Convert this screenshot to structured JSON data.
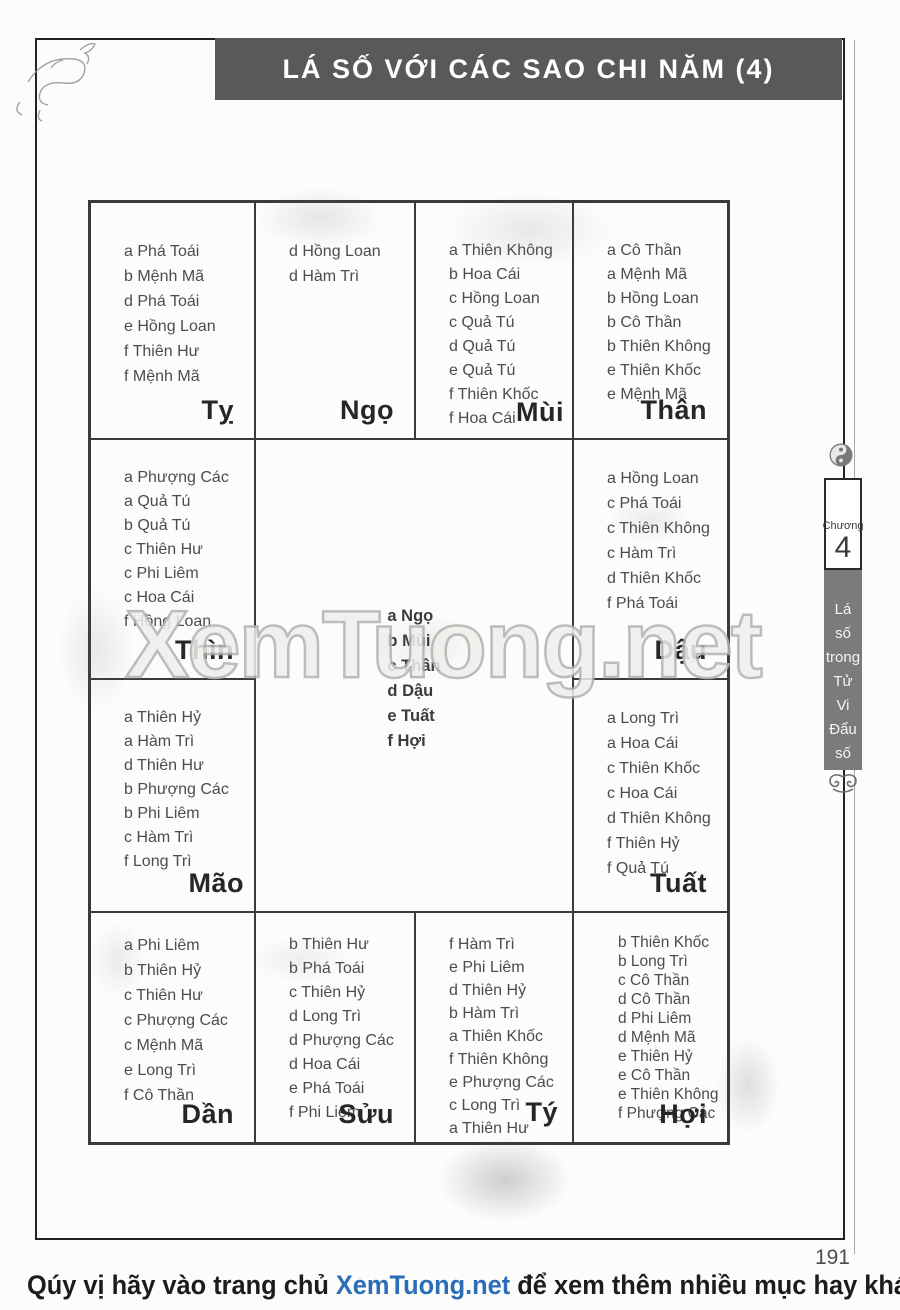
{
  "header": {
    "title": "LÁ SỐ VỚI CÁC SAO CHI NĂM (4)"
  },
  "sidebar": {
    "chapter_label": "Chương",
    "chapter_number": "4",
    "chapter_title_words": [
      "Lá",
      "số",
      "trong",
      "Tử",
      "Vi",
      "Đẩu",
      "số"
    ]
  },
  "watermark": {
    "text": "XemTuong.net"
  },
  "footer": {
    "page_number": "191",
    "promo_prefix": "Qúy vị hãy vào trang chủ ",
    "promo_link": "XemTuong.net",
    "promo_suffix": " để xem thêm nhiều mục hay khác",
    "link_color": "#2a6db8"
  },
  "chart": {
    "type": "table",
    "description": "Tử Vi palace chart of yearly stars by earthly branch",
    "cells": [
      {
        "id": "ty",
        "label": "Tỵ",
        "stars": [
          "a Phá Toái",
          "b Mệnh Mã",
          "d Phá Toái",
          "e Hồng Loan",
          "f Thiên Hư",
          "f Mệnh Mã"
        ]
      },
      {
        "id": "ngo",
        "label": "Ngọ",
        "stars": [
          "d Hồng Loan",
          "d Hàm Trì"
        ]
      },
      {
        "id": "mui",
        "label": "Mùi",
        "stars": [
          "a Thiên Không",
          "b Hoa Cái",
          "c Hồng Loan",
          "c Quả Tú",
          "d Quả Tú",
          "e Quả Tú",
          "f Thiên Khốc",
          "f Hoa Cái"
        ]
      },
      {
        "id": "than",
        "label": "Thân",
        "stars": [
          "a Cô Thần",
          "a Mệnh Mã",
          "b Hồng Loan",
          "b Cô Thần",
          "b Thiên Không",
          "e Thiên Khốc",
          "e Mệnh Mã"
        ]
      },
      {
        "id": "thin",
        "label": "Thìn",
        "stars": [
          "a Phượng Các",
          "a Quả Tú",
          "b Quả Tú",
          "c Thiên Hư",
          "c Phi Liêm",
          "c Hoa Cái",
          "f Hồng Loan"
        ]
      },
      {
        "id": "dau",
        "label": "Dậu",
        "stars": [
          "a Hồng Loan",
          "c Phá Toái",
          "c Thiên Không",
          "c Hàm Trì",
          "d Thiên Khốc",
          "f Phá Toái"
        ]
      },
      {
        "id": "mao",
        "label": "Mão",
        "stars": [
          "a Thiên Hỷ",
          "a Hàm Trì",
          "d Thiên Hư",
          "b Phượng Các",
          "b Phi Liêm",
          "c Hàm Trì",
          "f Long Trì"
        ]
      },
      {
        "id": "tuat",
        "label": "Tuất",
        "stars": [
          "a Long Trì",
          "a Hoa Cái",
          "c Thiên Khốc",
          "c Hoa Cái",
          "d Thiên Không",
          "f Thiên Hỷ",
          "f Quả Tú"
        ]
      },
      {
        "id": "dan",
        "label": "Dần",
        "stars": [
          "a Phi Liêm",
          "b Thiên Hỷ",
          "c Thiên Hư",
          "c Phượng Các",
          "c Mệnh Mã",
          "e Long Trì",
          "f Cô Thần"
        ]
      },
      {
        "id": "suu",
        "label": "Sửu",
        "stars": [
          "b Thiên Hư",
          "b Phá Toái",
          "c Thiên Hỷ",
          "d Long Trì",
          "d Phượng Các",
          "d Hoa Cái",
          "e Phá Toái",
          "f Phi Liêm"
        ]
      },
      {
        "id": "ti",
        "label": "Tý",
        "stars": [
          "f Hàm Trì",
          "e Phi Liêm",
          "d Thiên Hỷ",
          "b Hàm Trì",
          "a Thiên Khốc",
          "f Thiên Không",
          "e Phượng Các",
          "c Long Trì",
          "a Thiên Hư"
        ]
      },
      {
        "id": "hoi",
        "label": "Hợi",
        "stars": [
          "b Thiên Khốc",
          "b Long Trì",
          "c Cô Thần",
          "d Cô Thần",
          "d Phi Liêm",
          "d Mệnh Mã",
          "e Thiên Hỷ",
          "e Cô Thần",
          "e Thiên Không",
          "f Phượng Các"
        ]
      }
    ],
    "center": {
      "stars": [
        "a Ngọ",
        "b Mùi",
        "c Thân",
        "d Dậu",
        "e Tuất",
        "f Hợi"
      ]
    }
  }
}
